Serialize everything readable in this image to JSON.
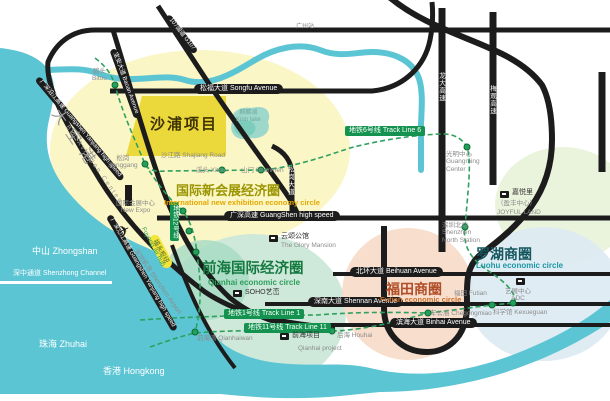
{
  "zones": {
    "shapu": {
      "title": "沙浦项目"
    },
    "exhibition": {
      "cn": "国际新会展经济圈",
      "en": "International new exhibition economy circle"
    },
    "qianhai": {
      "cn": "前海国际经济圈",
      "en": "Qianhai economic circle"
    },
    "futian": {
      "cn": "福田商圈",
      "en": "Futian economic circle"
    },
    "luohu": {
      "cn": "罗湖商圈",
      "en": "Luohu economic circle"
    }
  },
  "roads": {
    "songfu": "松福大道 Songfu Avenue",
    "shajiang": "沙江路 Shajiang Road",
    "guangshen": "广深高速 GuangShen high speed",
    "beihuan": "北环大道 Beihuan Avenue",
    "shennan": "深南大道 Shennan Avenue",
    "binhai": "滨海大道 Binhai Avenue",
    "baoan": "宝安大道 Baoan Avenue",
    "g107": "107国道 G107",
    "yanjiang_upper": "广深沿江高速 Guangshen Yanjiang high speed",
    "yanjiang_lower": "广深沿江高速 Guangshen Yanjiang high speed",
    "longda": "龙大高速",
    "meiguan": "梅观高速",
    "songgang_ave": "松岗大道"
  },
  "metro": {
    "line6": "地铁6号线 Track Line 6",
    "line1": "地铁1号线 Track Line 1",
    "line11": "地铁11号线 Track Line 11",
    "line12": "地铁12号线"
  },
  "stations": {
    "bitou_cn": "碧头",
    "bitou_en": "Bitou",
    "songgang_cn": "松岗",
    "songgang_en": "Songgang",
    "xitou": "溪头 Xitou",
    "shanmen": "山门 Shanmen",
    "guangming_cn": "光明中心",
    "guangming_en1": "Guangming",
    "guangming_en2": "Center",
    "szbei_cn": "深圳北站",
    "szbei_en1": "Shenzhen",
    "szbei_en2": "North Station",
    "newexpo_cn": "国际会展中心",
    "newexpo_en": "New Expo",
    "futian": "福田 Futian",
    "chegongmiao": "车公庙 Chegongmiao",
    "kexueguan": "科学馆 Kexueguan",
    "houhai": "后海 Houhai",
    "qianhaiwan": "前海湾 Qianhaiwan",
    "guangzhou": "广州站"
  },
  "projects": {
    "glory_cn": "云颂公馆",
    "glory_en": "The Glory Mansion",
    "soho": "SOHO艺峦",
    "qianhai_cn": "前海项目",
    "qianhai_en": "Qianhai project",
    "joyful_cn": "嘉悦里",
    "joyful_sub": "（盈丰中心）",
    "joyful_en": "JOYFUL LAND",
    "adc_cn": "艺展中心",
    "adc_en": "ADC"
  },
  "geography": {
    "zhongshan": "中山 Zhongshan",
    "shenzhong_channel": "深中通道 Shenzhong Channel",
    "zhuhai": "珠海 Zhuhai",
    "hongkong": "香港 Hongkong",
    "kirin_cn": "麒麟湖",
    "kirin_en": "Kirin lake",
    "airport": "深圳机场 Shenzhen Airport",
    "big_aviation_cn": "大空港",
    "big_aviation_en": "Big Aviation Center",
    "fuyong_cn": "福永枢纽",
    "fuyong_en": "Fuyong air hub"
  },
  "icons": {
    "plane": "✈"
  },
  "colors": {
    "water": "#5cc5d4",
    "road": "#1c1c1c",
    "metro_green": "#2fa05e",
    "badge_green": "#13934f",
    "zone_yellow": "#faf6c6",
    "shapu_yellow": "#ebd83b",
    "qianhai_green": "#cee9da",
    "futian_salmon": "#f7dbc9",
    "luohu_blue": "#dceaf2",
    "joyful_green": "#eaf3dc",
    "lake": "#9ed8cb",
    "fuyong_yellow": "#f2e63b"
  }
}
